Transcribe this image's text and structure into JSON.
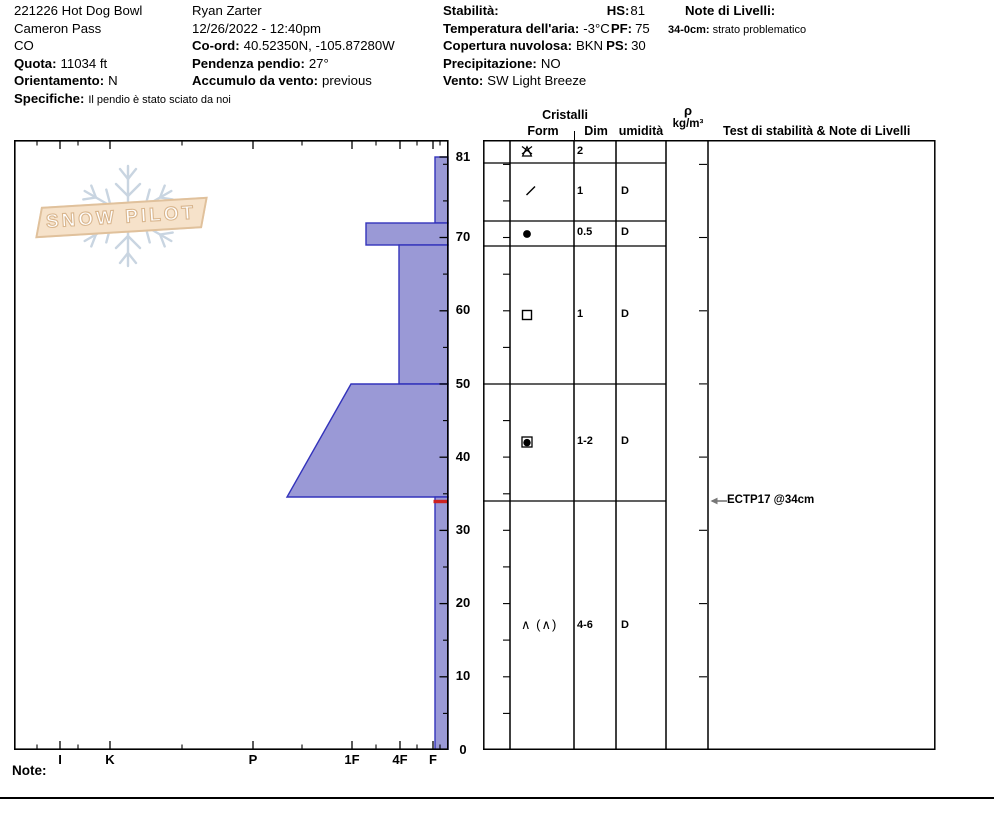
{
  "logo": {
    "text": "SNOW PILOT"
  },
  "header": {
    "pit_name": "221226 Hot Dog Bowl",
    "location": "Cameron Pass",
    "state": "CO",
    "elevation_label": "Quota:",
    "elevation_value": "11034 ft",
    "aspect_label": "Orientamento:",
    "aspect_value": "N",
    "notes_label": "Specifiche:",
    "notes_value": "Il pendio è stato sciato da noi",
    "observer": "Ryan Zarter",
    "datetime": "12/26/2022 - 12:40pm",
    "coord_label": "Co-ord:",
    "coord_value": "40.52350N, -105.87280W",
    "slope_label": "Pendenza pendio:",
    "slope_value": "27°",
    "wind_loading_label": "Accumulo da vento:",
    "wind_loading_value": "previous",
    "stability_label": "Stabilità:",
    "air_temp_label": "Temperatura dell'aria:",
    "air_temp_value": "-3°C",
    "sky_label": "Copertura nuvolosa:",
    "sky_value": "BKN",
    "precip_label": "Precipitazione:",
    "precip_value": "NO",
    "wind_label": "Vento:",
    "wind_value": "SW Light Breeze",
    "hs_label": "HS:",
    "hs_value": "81",
    "pf_label": "PF:",
    "pf_value": "75",
    "ps_label": "PS:",
    "ps_value": "30",
    "layer_notes_label": "Note di Livelli:",
    "layer_note_range": "34-0cm:",
    "layer_note_text": "strato problematico"
  },
  "table_headers": {
    "cristalli": "Cristalli",
    "form": "Form",
    "dim": "Dim",
    "humidity": "umidità",
    "rho_top": "ρ",
    "rho_bottom": "kg/m³",
    "tests": "Test di stabilità & Note di Livelli"
  },
  "crystal_rows": [
    {
      "grain": "PP - precipitation particles (stellar)",
      "dim": "2",
      "moisture": ""
    },
    {
      "grain": "DF - decomposing fragments",
      "dim": "1",
      "moisture": "D"
    },
    {
      "grain": "RG - rounded grains",
      "dim": "0.5",
      "moisture": "D"
    },
    {
      "grain": "FC - faceted crystals",
      "dim": "1",
      "moisture": "D"
    },
    {
      "grain": "FC/RG - mixed facets and rounds",
      "dim": "1-2",
      "moisture": "D"
    },
    {
      "grain": "DH - depth hoar",
      "symbol_text": "∧ (∧)",
      "dim": "4-6",
      "moisture": "D"
    }
  ],
  "depth_labels": [
    "81",
    "70",
    "60",
    "50",
    "40",
    "30",
    "20",
    "10",
    "0"
  ],
  "hardness_labels": [
    "I",
    "K",
    "P",
    "1F",
    "4F",
    "F"
  ],
  "annotation": {
    "text": "ECTP17 @34cm"
  },
  "footer": {
    "note_label": "Note:"
  },
  "chart_data": {
    "type": "snow-profile (hardness bar profile vs depth)",
    "title": "221226 Hot Dog Bowl",
    "depth_axis": {
      "unit": "cm",
      "surface": 81,
      "range": [
        0,
        81
      ],
      "major_ticks": [
        81,
        70,
        60,
        50,
        40,
        30,
        20,
        10,
        0
      ],
      "minor_tick_step_cm": 5
    },
    "hardness_axis": {
      "categories": [
        "I",
        "K",
        "P",
        "1F",
        "4F",
        "F"
      ],
      "note": "hand hardness, hardest (I) at left, softest (F) at right"
    },
    "layers": [
      {
        "top_cm": 81,
        "bottom_cm": 78,
        "hardness": "F",
        "grain_form": "PP (stellar)",
        "grain_size_mm": "2",
        "moisture": ""
      },
      {
        "top_cm": 78,
        "bottom_cm": 72,
        "hardness": "F",
        "grain_form": "DF",
        "grain_size_mm": "1",
        "moisture": "D"
      },
      {
        "top_cm": 72,
        "bottom_cm": 69,
        "hardness": "1F",
        "grain_form": "RG",
        "grain_size_mm": "0.5",
        "moisture": "D"
      },
      {
        "top_cm": 69,
        "bottom_cm": 50,
        "hardness": "4F",
        "grain_form": "FC",
        "grain_size_mm": "1",
        "moisture": "D"
      },
      {
        "top_cm": 50,
        "bottom_cm": 34,
        "hardness": "1F to P",
        "grain_form": "FC/RG mixed",
        "grain_size_mm": "1-2",
        "moisture": "D"
      },
      {
        "top_cm": 34,
        "bottom_cm": 0,
        "hardness": "F",
        "grain_form": "DH (DH)",
        "grain_size_mm": "4-6",
        "moisture": "D"
      }
    ],
    "flagged_layer": {
      "depth_cm": 34,
      "note": "strato problematico"
    },
    "stability_tests": [
      {
        "result": "ECTP17 @34cm",
        "depth_cm": 34
      }
    ],
    "colors": {
      "layer_fill": "#9a99d6",
      "layer_stroke": "#3333bb",
      "flag_red": "#cc2222",
      "logo_flake": "#c9d5e1",
      "logo_banner": "#f6e2ca"
    },
    "legend_position": "none",
    "grid": "off"
  }
}
